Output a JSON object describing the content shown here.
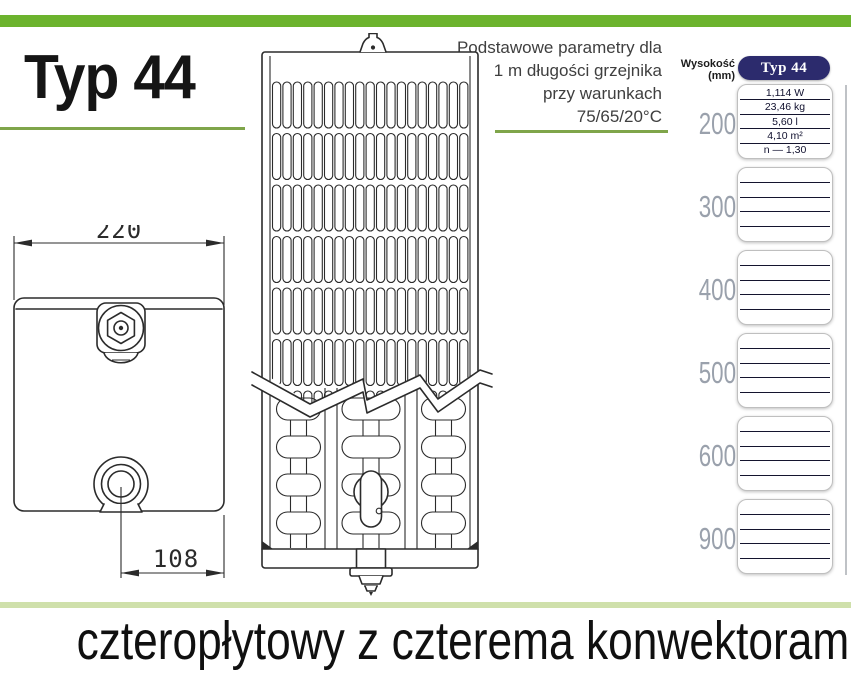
{
  "header": {
    "top_title": "Typ 44",
    "params_note": {
      "line1": "Podstawowe parametry dla",
      "line2": "1 m długości grzejnika",
      "line3": "przy warunkach",
      "line4": "75/65/20°C"
    }
  },
  "drawing": {
    "width_dim_mm": "220",
    "bottom_offset_dim_mm": "108"
  },
  "spec_table": {
    "row_axis_label": "Wysokość (mm)",
    "column_header": "Typ 44",
    "heights": [
      "200",
      "300",
      "400",
      "500",
      "600",
      "900"
    ],
    "values_200": [
      "1,114 W",
      "23,46 kg",
      "5,60 l",
      "4,10 m²",
      "n — 1,30"
    ]
  },
  "footer": {
    "caption": "czteropłytowy z czterema konwektorami"
  },
  "colors": {
    "accent_green": "#6cb32e",
    "line_green": "#7fa54a",
    "pale_green": "#cfe0ab",
    "navy": "#2c2b6d",
    "label_gray": "#9aa1ac"
  }
}
